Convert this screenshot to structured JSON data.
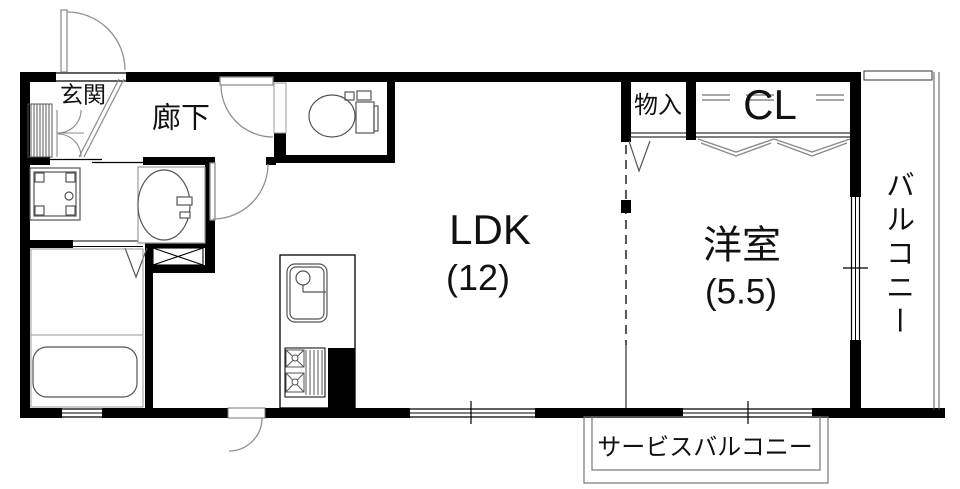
{
  "rooms": {
    "genkan": "玄関",
    "hallway": "廊下",
    "ldk": "LDK",
    "ldk_size": "(12)",
    "storage": "物入",
    "closet": "CL",
    "bedroom": "洋室",
    "bedroom_size": "(5.5)",
    "balcony": "バルコニー",
    "service_balcony": "サービスバルコニー"
  },
  "colors": {
    "wall": "#000000",
    "thin_line": "#8a8a8a",
    "text": "#111111",
    "background": "#ffffff"
  }
}
